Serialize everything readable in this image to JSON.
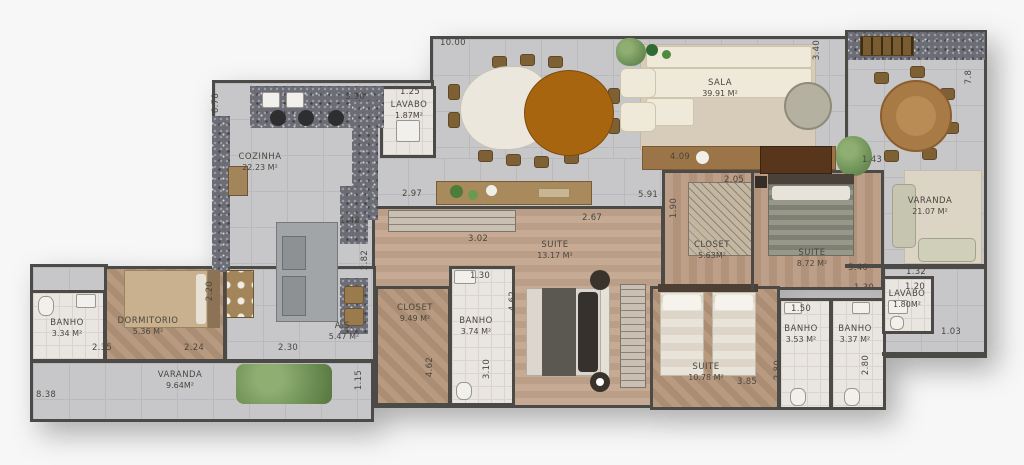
{
  "rooms": {
    "cozinha": {
      "label": "COZINHA",
      "area": "22.23 M²"
    },
    "lavabo_social": {
      "label": "LAVABO",
      "area": "1.87M²"
    },
    "sala": {
      "label": "SALA",
      "area": "39.91 M²"
    },
    "varanda_gourmet": {
      "label": "VARANDA",
      "area": "21.07 M²"
    },
    "suite_1": {
      "label": "SUITE",
      "area": "13.17 M²"
    },
    "closet_1": {
      "label": "CLOSET",
      "area": "5.63M²"
    },
    "suite_2": {
      "label": "SUITE",
      "area": "8.72 M²"
    },
    "closet_2": {
      "label": "CLOSET",
      "area": "9.49 M²"
    },
    "banho_1": {
      "label": "BANHO",
      "area": "3.74 M²"
    },
    "suite_3": {
      "label": "SUITE",
      "area": "10.78 M²"
    },
    "banho_2": {
      "label": "BANHO",
      "area": "3.53 M²"
    },
    "banho_3": {
      "label": "BANHO",
      "area": "3.37 M²"
    },
    "lavabo_2": {
      "label": "LAVABO",
      "area": "1.80M²"
    },
    "banho_4": {
      "label": "BANHO",
      "area": "3.34 M²"
    },
    "dormitorio": {
      "label": "DORMITORIO",
      "area": "5.36 M²"
    },
    "area_servico": {
      "label": "A.S.",
      "area": "5.47 M²"
    },
    "varanda_2": {
      "label": "VARANDA",
      "area": "9.64M²"
    }
  },
  "dims": [
    "10.00",
    "6.78",
    "3.90",
    "1.25",
    "3.40",
    "7.8",
    "2.97",
    "1.48",
    "2.82",
    "2.20",
    "3.02",
    "2.67",
    "5.91",
    "4.09",
    "2.05",
    "1.90",
    "1.43",
    "5.40",
    "1.30",
    "1.32",
    "1.20",
    "1.03",
    "1.30",
    "4.62",
    "4.62",
    "3.10",
    "2.30",
    "2.35",
    "2.24",
    "8.38",
    "1.15",
    "3.85",
    "2.80",
    "2.80",
    "1.50"
  ],
  "colors": {
    "wall": "#4b4a46",
    "tile_gray": "#c7c7c9",
    "tile_white": "#e9e6e2",
    "wood": "#b79a80",
    "granite_counter": "#6b6c74",
    "rug": "#d7ccba",
    "table_brown": "#a8650f",
    "plant_green": "#6f9258",
    "background": "#f7f7f7"
  }
}
